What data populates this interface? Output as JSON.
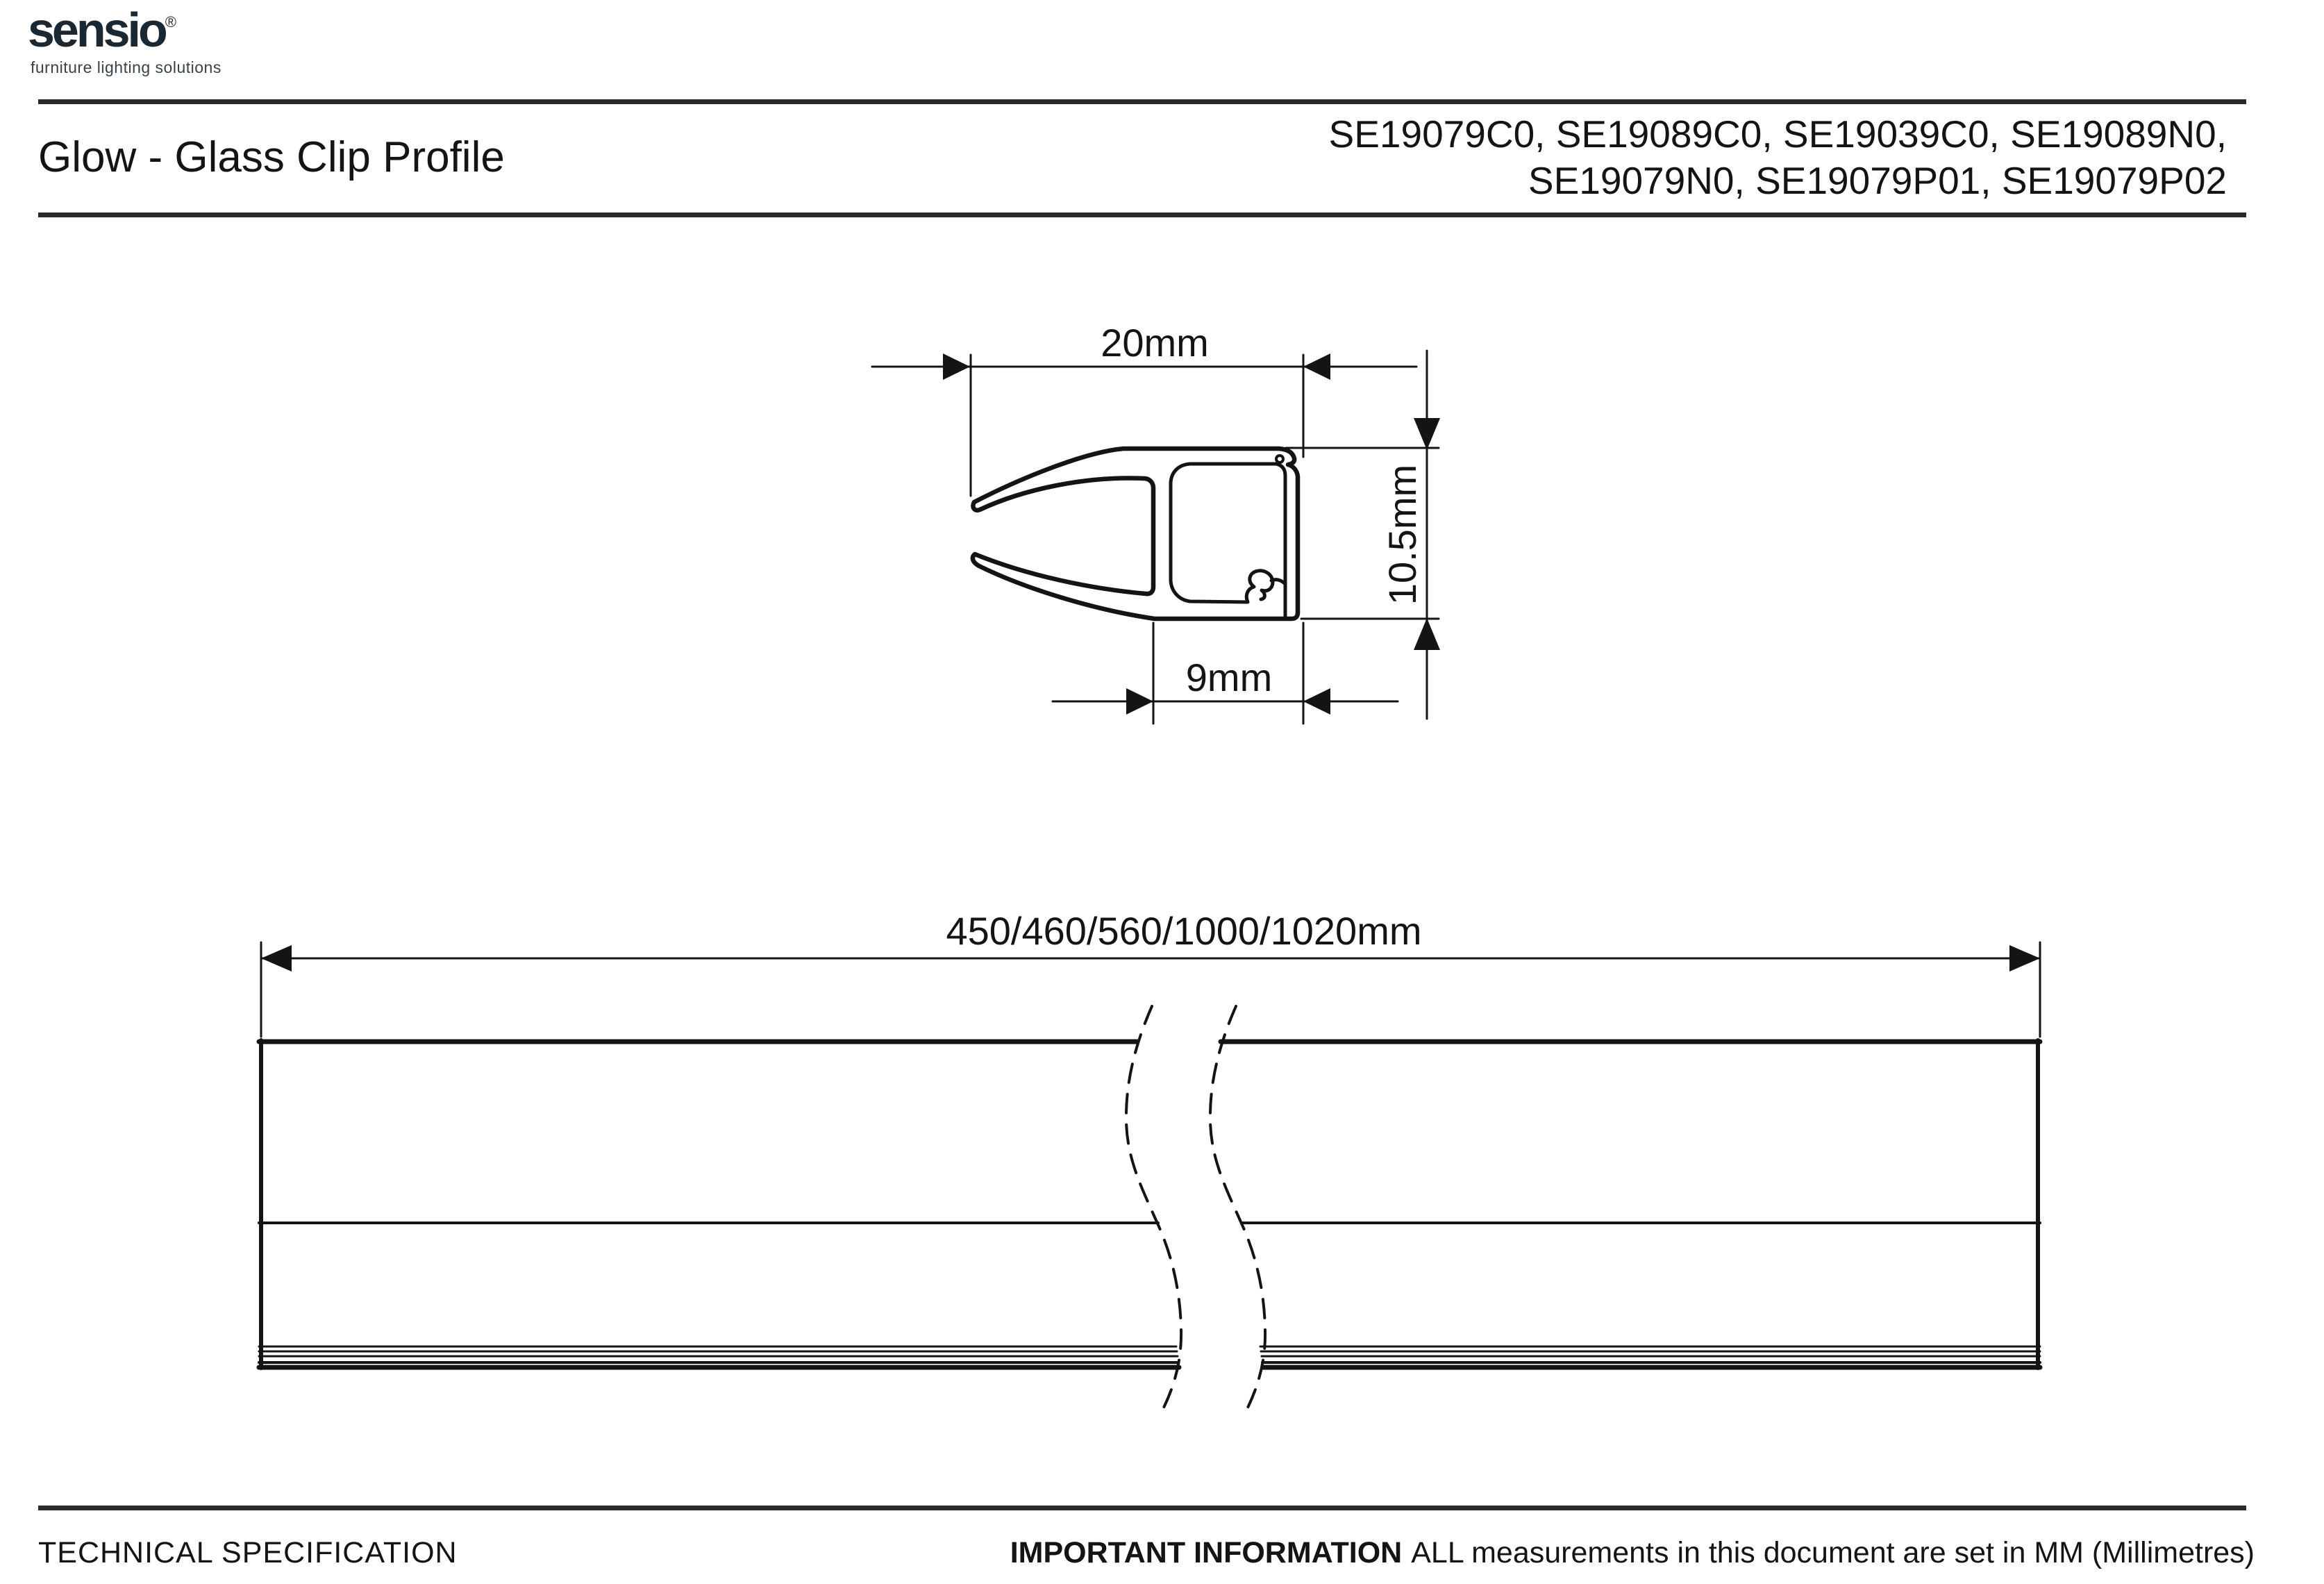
{
  "page": {
    "background": "#ffffff",
    "line_color": "#141414",
    "rule_color": "#2a2a2a"
  },
  "logo": {
    "brand": "sensio",
    "registered": "®",
    "tagline": "furniture lighting solutions",
    "accent_green": "#74b62c",
    "brand_color": "#1b2832"
  },
  "header": {
    "title": "Glow - Glass Clip Profile",
    "codes_line1": "SE19079C0, SE19089C0, SE19039C0, SE19089N0,",
    "codes_line2": "SE19079N0, SE19079P01, SE19079P02"
  },
  "section_view": {
    "dim_width": "20mm",
    "dim_height": "10.5mm",
    "dim_channel_width": "9mm"
  },
  "profile_view": {
    "dim_length": "450/460/560/1000/1020mm"
  },
  "footer": {
    "left": "TECHNICAL SPECIFICATION",
    "right_bold": "IMPORTANT INFORMATION",
    "right_rest": "ALL measurements in this document are set in MM (Millimetres)"
  }
}
